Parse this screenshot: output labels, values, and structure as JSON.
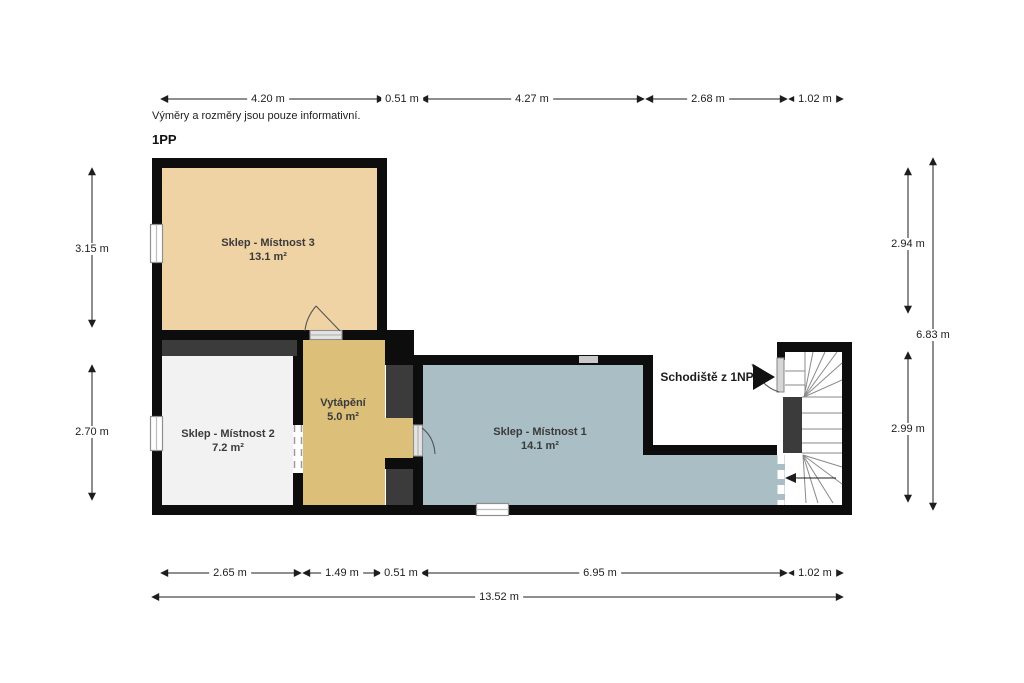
{
  "floor_title": "1PP",
  "note": "Výměry a rozměry jsou pouze informativní.",
  "stairs_label": "Schodiště z 1NP",
  "rooms": [
    {
      "name": "Sklep - Místnost 3",
      "area": "13.1 m²",
      "color": "#efd3a4"
    },
    {
      "name": "Sklep - Místnost 2",
      "area": "7.2 m²",
      "color": "#f2f2f2"
    },
    {
      "name": "Vytápění",
      "area": "5.0 m²",
      "color": "#dcc07a"
    },
    {
      "name": "Sklep - Místnost 1",
      "area": "14.1 m²",
      "color": "#a9bec5"
    }
  ],
  "dimensions": {
    "top": [
      "4.20 m",
      "0.51 m",
      "4.27 m",
      "2.68 m",
      "1.02 m"
    ],
    "bottom": [
      "2.65 m",
      "1.49 m",
      "0.51 m",
      "6.95 m",
      "1.02 m"
    ],
    "bottom_total": "13.52 m",
    "left": [
      "3.15 m",
      "2.70 m"
    ],
    "right": [
      "2.94 m",
      "2.99 m"
    ],
    "right_total": "6.83 m"
  },
  "colors": {
    "wall": "#0d0d0d",
    "mass": "#3b3b3b",
    "dimension_line": "#1d1d1d",
    "tread_line": "#8a8a8a"
  }
}
